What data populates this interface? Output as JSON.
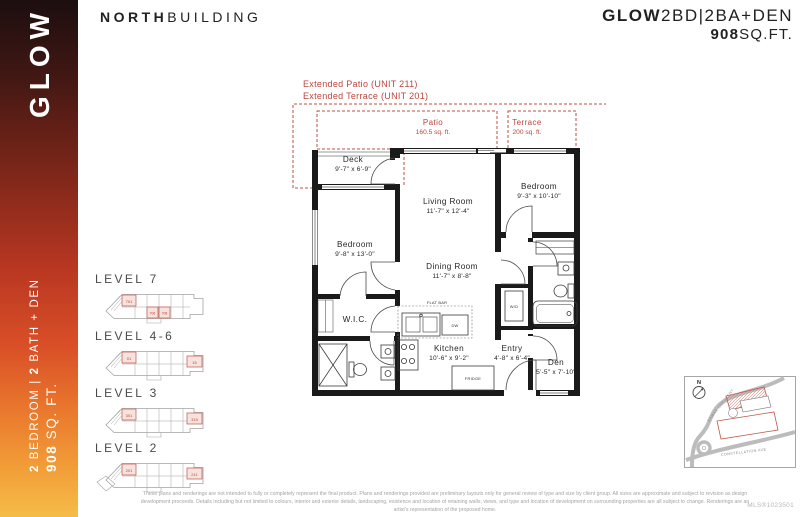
{
  "header": {
    "building_bold": "NORTH",
    "building_rest": "BUILDING",
    "plan_bold": "GLOW",
    "plan_rest": "2BD|2BA+DEN",
    "sqft_bold": "908",
    "sqft_rest": "SQ.FT."
  },
  "sidebar": {
    "brand": "GLOW",
    "spec_n1": "2",
    "spec_t1": " BEDROOM | ",
    "spec_n2": "2",
    "spec_t2": " BATH + DEN",
    "sqft_n": "908",
    "sqft_t": " SQ. FT."
  },
  "plan": {
    "annotation_line1": "Extended Patio (UNIT 211)",
    "annotation_line2": "Extended Terrace (UNIT 201)",
    "outdoor": {
      "patio_name": "Patio",
      "patio_area": "160.5 sq. ft.",
      "terrace_name": "Terrace",
      "terrace_area": "200 sq. ft.",
      "deck_name": "Deck",
      "deck_dims": "9'-7\" x 6'-9\""
    },
    "rooms": {
      "living_name": "Living Room",
      "living_dims": "11'-7\" x 12'-4\"",
      "bedroom_right_name": "Bedroom",
      "bedroom_right_dims": "9'-3\" x 10'-10\"",
      "bedroom_left_name": "Bedroom",
      "bedroom_left_dims": "9'-8\" x 13'-0\"",
      "dining_name": "Dining Room",
      "dining_dims": "11'-7\" x 8'-8\"",
      "wic_name": "W.I.C.",
      "kitchen_name": "Kitchen",
      "kitchen_dims": "10'-6\" x 9'-2\"",
      "entry_name": "Entry",
      "entry_dims": "4'-8\" x 6'-4\"",
      "den_name": "Den",
      "den_dims": "5'-5\" x 7'-10\""
    },
    "fixtures": {
      "flat_bar": "FLAT BAR",
      "fridge": "FRIDGE",
      "wd": "W/D",
      "dw": "DW"
    }
  },
  "levels": [
    {
      "label": "LEVEL 7",
      "units": [
        "701",
        "706",
        "708"
      ]
    },
    {
      "label": "LEVEL 4-6",
      "units": [
        "01",
        "15"
      ]
    },
    {
      "label": "LEVEL 3",
      "units": [
        "301",
        "315"
      ]
    },
    {
      "label": "LEVEL 2",
      "units": [
        "201",
        "211"
      ]
    }
  ],
  "map": {
    "compass": "N",
    "street1": "SAMAR CRESCENT",
    "street2": "CONSTELLATION AVE"
  },
  "footer": {
    "disclaimer_line1": "These plans and renderings are not intended to fully or completely represent the final product. Plans and renderings provided are preliminary layouts only for general review of type and size by client group. All sizes are approximate and subject to revision as design",
    "disclaimer_line2": "development proceeds. Details including but not limited to colours, interior and exterior details, landscaping, existence and location of retaining walls, views, and type and location of development on surrounding properties are all subject to change. Renderings are an",
    "disclaimer_line3": "artist's representation of the proposed home.",
    "mls": "MLS®1023501"
  },
  "colors": {
    "accent_red": "#b9463c",
    "wall_black": "#1a1a1a",
    "gradient_top": "#1c0e0f",
    "gradient_bottom": "#f5bc49"
  }
}
